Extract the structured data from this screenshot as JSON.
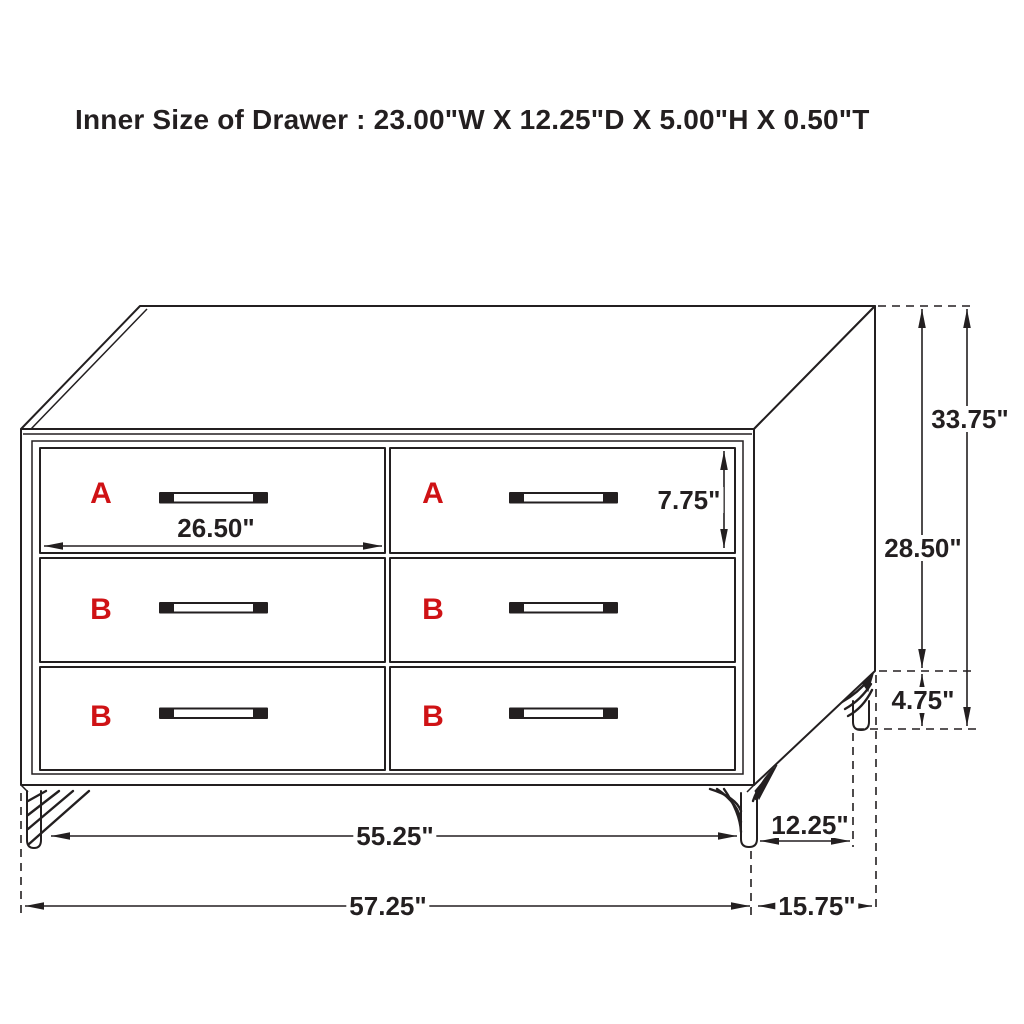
{
  "title": "Inner Size of Drawer : 23.00\"W X 12.25\"D X 5.00\"H X 0.50\"T",
  "labels": {
    "top_left_drawer": "A",
    "top_right_drawer": "A",
    "middle_left_drawer": "B",
    "middle_right_drawer": "B",
    "bottom_left_drawer": "B",
    "bottom_right_drawer": "B"
  },
  "dimensions": {
    "drawer_face_width": "26.50\"",
    "drawer_face_height": "7.75\"",
    "overall_height": "33.75\"",
    "body_height": "28.50\"",
    "leg_height": "4.75\"",
    "width_between_leg_feet": "55.25\"",
    "depth_between_leg_feet": "12.25\"",
    "overall_width": "57.25\"",
    "overall_depth": "15.75\""
  },
  "colors": {
    "line": "#231f20",
    "label": "#cf1215",
    "background": "#ffffff"
  }
}
